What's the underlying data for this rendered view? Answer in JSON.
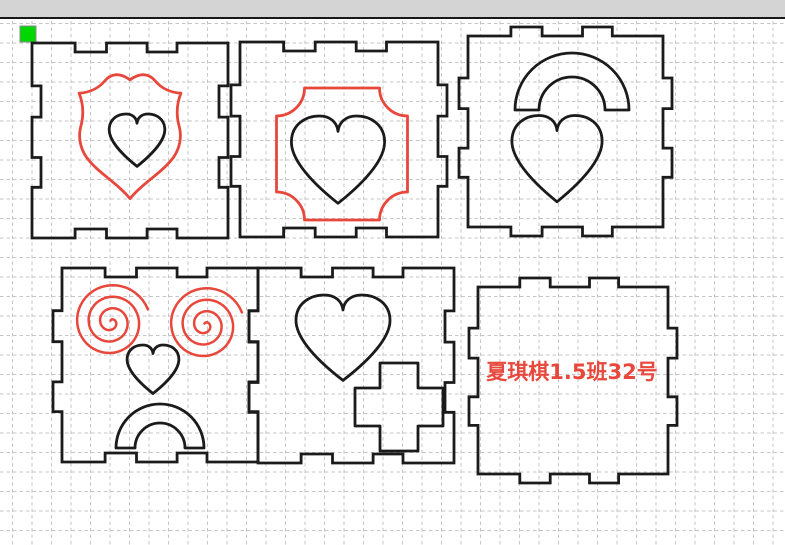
{
  "colors": {
    "toolbar_bg": "#d4d4d4",
    "toolbar_border": "#181818",
    "canvas_bg": "#ffffff",
    "grid": "#c6c6c6",
    "cut_outline": "#1b1b1b",
    "engrave_red": "#e8473c",
    "selection_green": "#00d600",
    "selection_border": "#8b8b8b"
  },
  "grid": {
    "spacing": 19.5,
    "offset_x": 12.5,
    "offset_y": 23.5,
    "dash": "3.5 3",
    "top": 21
  },
  "selection_handle": {
    "x": 20,
    "y": 26,
    "size": 16
  },
  "panel_style": {
    "notches": [
      [
        0.22,
        0.38
      ],
      [
        0.587,
        0.74
      ]
    ],
    "depth": 9,
    "stroke_width": 2.8
  },
  "panels": [
    {
      "name": "panel-top-left",
      "x": 32,
      "y": 43,
      "w": 196,
      "h": 195,
      "edges": {
        "top": "in",
        "right": "in",
        "bottom": "in",
        "left": "in"
      },
      "shapes": [
        {
          "kind": "shield",
          "stroke": "red",
          "cx": 130,
          "cy": 137,
          "w": 106,
          "h": 127
        },
        {
          "kind": "heart",
          "stroke": "black",
          "cx": 137,
          "cy": 141,
          "w": 58,
          "h": 54
        }
      ]
    },
    {
      "name": "panel-top-middle",
      "x": 240,
      "y": 42,
      "w": 198,
      "h": 195,
      "edges": {
        "top": "in",
        "right": "out",
        "bottom": "in",
        "left": "out"
      },
      "shapes": [
        {
          "kind": "frame",
          "stroke": "red",
          "cx": 342,
          "cy": 154,
          "w": 131,
          "h": 132,
          "corner_radius": 28
        },
        {
          "kind": "heart",
          "stroke": "black",
          "cx": 338,
          "cy": 161,
          "w": 97,
          "h": 90
        }
      ]
    },
    {
      "name": "panel-top-right",
      "x": 468,
      "y": 36,
      "w": 195,
      "h": 191,
      "edges": {
        "top": "out",
        "right": "out",
        "bottom": "out",
        "left": "out"
      },
      "shapes": [
        {
          "kind": "arch",
          "stroke": "black",
          "cx": 572,
          "cy": 110,
          "outer_r": 57,
          "inner_r": 33
        },
        {
          "kind": "heart",
          "stroke": "black",
          "cx": 557,
          "cy": 160,
          "w": 94,
          "h": 89
        }
      ]
    },
    {
      "name": "panel-bottom-left",
      "x": 62,
      "y": 268,
      "w": 196,
      "h": 194,
      "edges": {
        "top": "in",
        "right": "in",
        "bottom": "in",
        "left": "out"
      },
      "shapes": [
        {
          "kind": "spiral",
          "stroke": "red",
          "cx": 111,
          "cy": 322,
          "r": 39,
          "turns": 3.25
        },
        {
          "kind": "spiral",
          "stroke": "red",
          "cx": 205,
          "cy": 325,
          "r": 39,
          "turns": 3.25
        },
        {
          "kind": "heart",
          "stroke": "black",
          "cx": 153,
          "cy": 370,
          "w": 54,
          "h": 50
        },
        {
          "kind": "arch",
          "stroke": "black",
          "cx": 160,
          "cy": 448,
          "outer_r": 44,
          "inner_r": 25
        }
      ]
    },
    {
      "name": "panel-bottom-middle",
      "x": 258,
      "y": 268,
      "w": 196,
      "h": 195,
      "edges": {
        "top": "in",
        "right": "in",
        "bottom": "in",
        "left": "out"
      },
      "shapes": [
        {
          "kind": "heart",
          "stroke": "black",
          "cx": 343,
          "cy": 339,
          "w": 98,
          "h": 88
        },
        {
          "kind": "cross",
          "stroke": "black",
          "cx": 399,
          "cy": 407,
          "size": 88,
          "arm": 38
        }
      ]
    },
    {
      "name": "panel-bottom-right",
      "x": 478,
      "y": 287,
      "w": 190,
      "h": 187,
      "edges": {
        "top": "out",
        "right": "out",
        "bottom": "out",
        "left": "out"
      },
      "shapes": [
        {
          "kind": "text",
          "stroke": "red",
          "cx": 572,
          "cy": 372,
          "text": "夏琪棋1.5班32号",
          "font_size": 21
        }
      ]
    }
  ]
}
